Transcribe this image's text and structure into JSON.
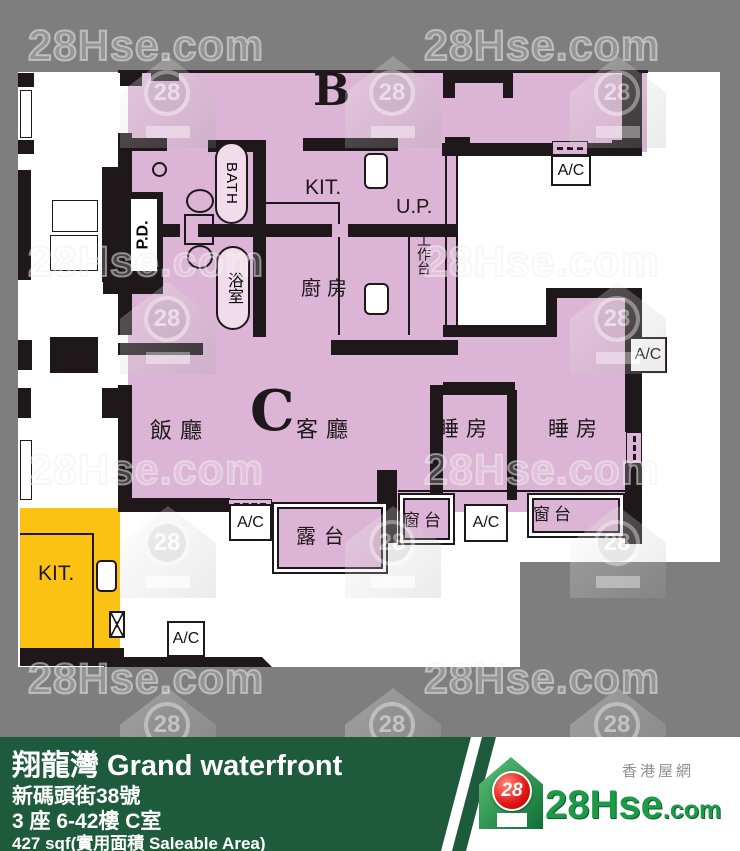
{
  "watermark": {
    "text": "28Hse.com",
    "badge": "28"
  },
  "plan": {
    "unit_b": "B",
    "unit_c": "C",
    "bath": "BATH",
    "bathroom": "浴室",
    "kit": "KIT.",
    "kitchen": "廚房",
    "pd": "P.D.",
    "up": "U.P.",
    "worktop": "工作台",
    "dining": "飯廳",
    "living": "客廳",
    "bedroom": "睡房",
    "balcony": "露台",
    "bay_window": "窗台",
    "ac": "A/C"
  },
  "info_bar": {
    "estate": "翔龍灣 Grand waterfront",
    "address": "新碼頭街38號",
    "unit": "3 座 6-42樓 C室",
    "area": "427 sqf(實用面積 Saleable Area)"
  },
  "logo": {
    "badge": "28",
    "brand": "28Hse",
    "tld": ".com",
    "tagline": "香港屋網"
  }
}
